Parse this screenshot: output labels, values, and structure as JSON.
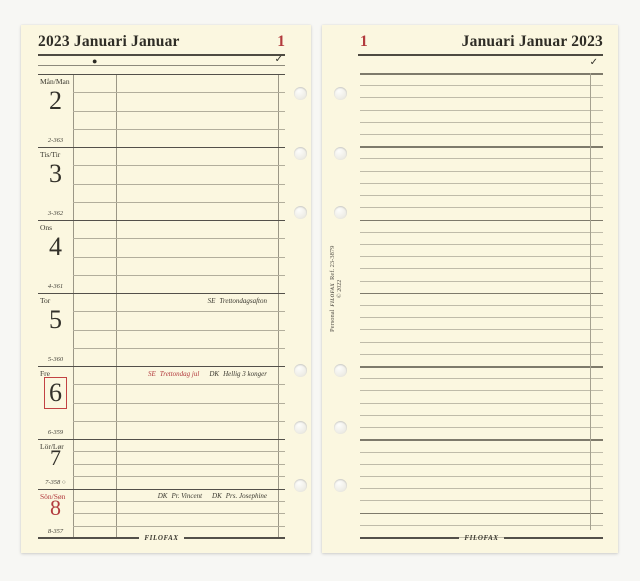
{
  "colors": {
    "page": "#fbf7e0",
    "accent_red": "#b23a3d",
    "ink": "#33312a",
    "rule_light": "#b2ae9c",
    "rule_dark": "#53504a"
  },
  "left_page": {
    "header": {
      "title": "2023 Januari Januar",
      "week_number": "1",
      "moon_icon": "●",
      "check_mark": "✓"
    },
    "days": [
      {
        "label": "Mån/Man",
        "date": "2",
        "code": "2-363",
        "red": false,
        "boxed": false,
        "notes": []
      },
      {
        "label": "Tis/Tir",
        "date": "3",
        "code": "3-362",
        "red": false,
        "boxed": false,
        "notes": []
      },
      {
        "label": "Ons",
        "date": "4",
        "code": "4-361",
        "red": false,
        "boxed": false,
        "notes": []
      },
      {
        "label": "Tor",
        "date": "5",
        "code": "5-360",
        "red": false,
        "boxed": false,
        "notes": [
          {
            "prefix": "SE",
            "text": "Trettondagsafton",
            "red": false
          }
        ]
      },
      {
        "label": "Fre",
        "date": "6",
        "code": "6-359",
        "red": false,
        "boxed": true,
        "notes": [
          {
            "prefix": "SE",
            "text": "Trettondag jul",
            "red": true
          },
          {
            "prefix": "DK",
            "text": "Hellig 3 konger",
            "red": false
          }
        ]
      },
      {
        "label": "Lör/Lør",
        "date": "7",
        "code": "7-358 ○",
        "red": false,
        "boxed": false,
        "notes": []
      },
      {
        "label": "Sön/Søn",
        "date": "8",
        "code": "8-357",
        "red": true,
        "boxed": false,
        "notes": [
          {
            "prefix": "DK",
            "text": "Pr. Vincent",
            "red": false
          },
          {
            "prefix": "DK",
            "text": "Prs. Josephine",
            "red": false
          }
        ]
      }
    ],
    "footer_logo": "filofax"
  },
  "right_page": {
    "header": {
      "week_number": "1",
      "title": "Januari Januar 2023",
      "check_mark": "✓"
    },
    "spine": {
      "prefix": "Personal",
      "logo": "filofax",
      "ref": "Ref. 23-3879",
      "copyright": "© 2022"
    },
    "footer_logo": "filofax"
  }
}
